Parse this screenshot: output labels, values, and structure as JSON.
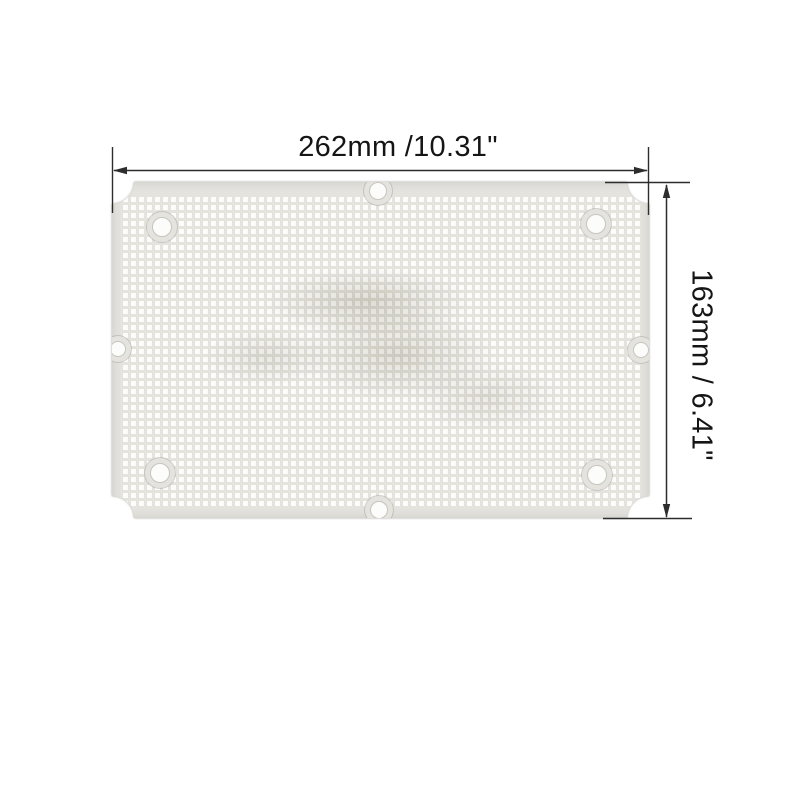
{
  "image_type": "product dimension illustration",
  "background_color": "#ffffff",
  "dimensions": {
    "width_label": "262mm /10.31\"",
    "height_label": "163mm / 6.41\""
  },
  "plate": {
    "name": "perforated mounting plate",
    "color": "#e4e3de",
    "hole_color": "#fcfcfb",
    "mounting_hole_count": 8,
    "mounting_holes": [
      {
        "cx": 50,
        "cy": 45,
        "r": 10
      },
      {
        "cx": 266,
        "cy": 9,
        "r": 9
      },
      {
        "cx": 484,
        "cy": 42,
        "r": 10
      },
      {
        "cx": 6,
        "cy": 167,
        "r": 8
      },
      {
        "cx": 529,
        "cy": 168,
        "r": 8
      },
      {
        "cx": 48,
        "cy": 291,
        "r": 10
      },
      {
        "cx": 485,
        "cy": 293,
        "r": 10
      },
      {
        "cx": 267,
        "cy": 328,
        "r": 9
      }
    ]
  },
  "annotation": {
    "line_color": "#2d2d2d",
    "text_color": "#151515"
  }
}
